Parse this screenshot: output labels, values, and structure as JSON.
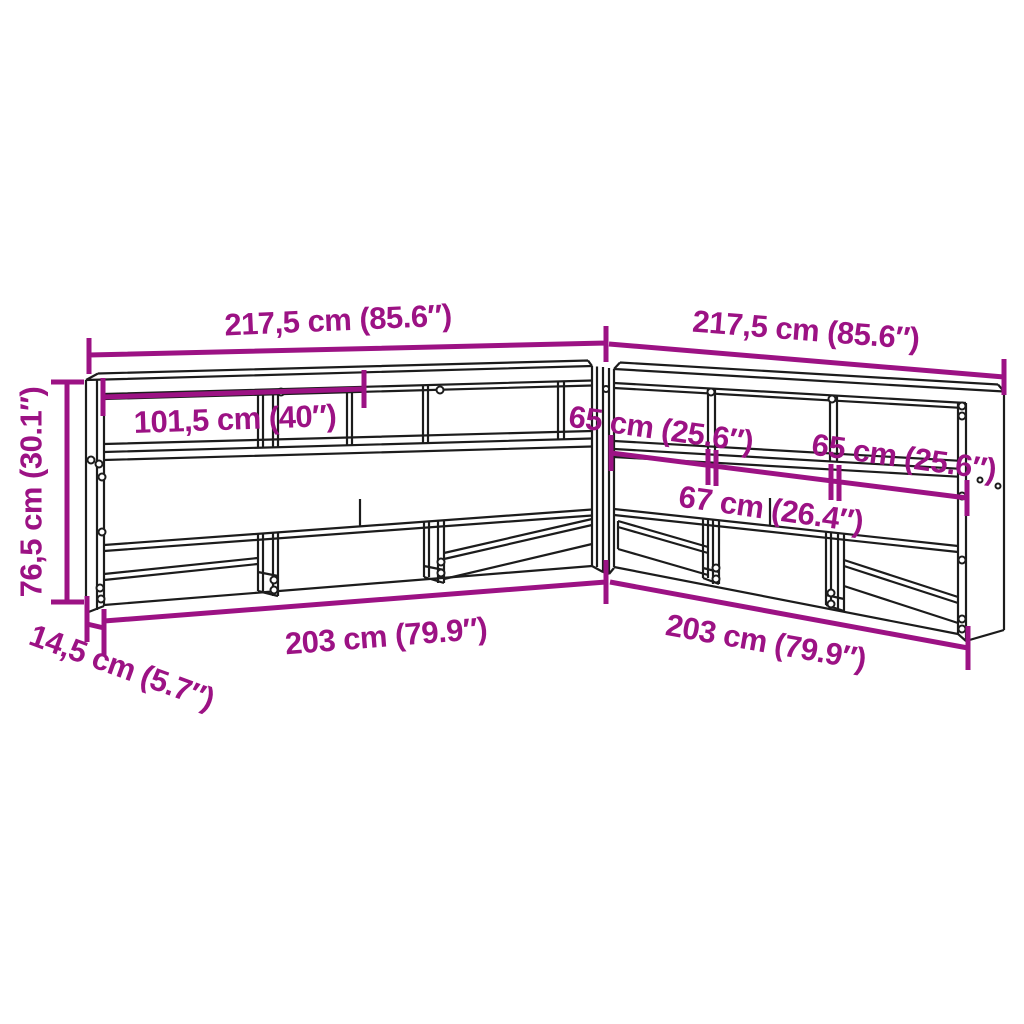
{
  "diagram": {
    "type": "furniture-dimension-diagram",
    "subject": "L-shaped corner bookcase headboard line drawing with dimension callouts",
    "colors": {
      "dimension_accent": "#9c1284",
      "outline": "#1c1c1c",
      "background": "#ffffff"
    },
    "dimensions": [
      {
        "id": "left-wing-total-width",
        "label": "217,5 cm (85.6″)"
      },
      {
        "id": "right-wing-total-width",
        "label": "217,5 cm (85.6″)"
      },
      {
        "id": "left-top-shelf-width",
        "label": "101,5 cm (40″)"
      },
      {
        "id": "right-shelf-section-1",
        "label": "65 cm (25.6″)"
      },
      {
        "id": "right-shelf-middle",
        "label": "67 cm (26.4″)"
      },
      {
        "id": "right-shelf-section-2",
        "label": "65 cm (25.6″)"
      },
      {
        "id": "height",
        "label": "76,5 cm (30.1″)"
      },
      {
        "id": "depth",
        "label": "14,5 cm (5.7″)"
      },
      {
        "id": "left-wing-inner-width",
        "label": "203 cm (79.9″)"
      },
      {
        "id": "right-wing-inner-width",
        "label": "203 cm (79.9″)"
      }
    ]
  }
}
